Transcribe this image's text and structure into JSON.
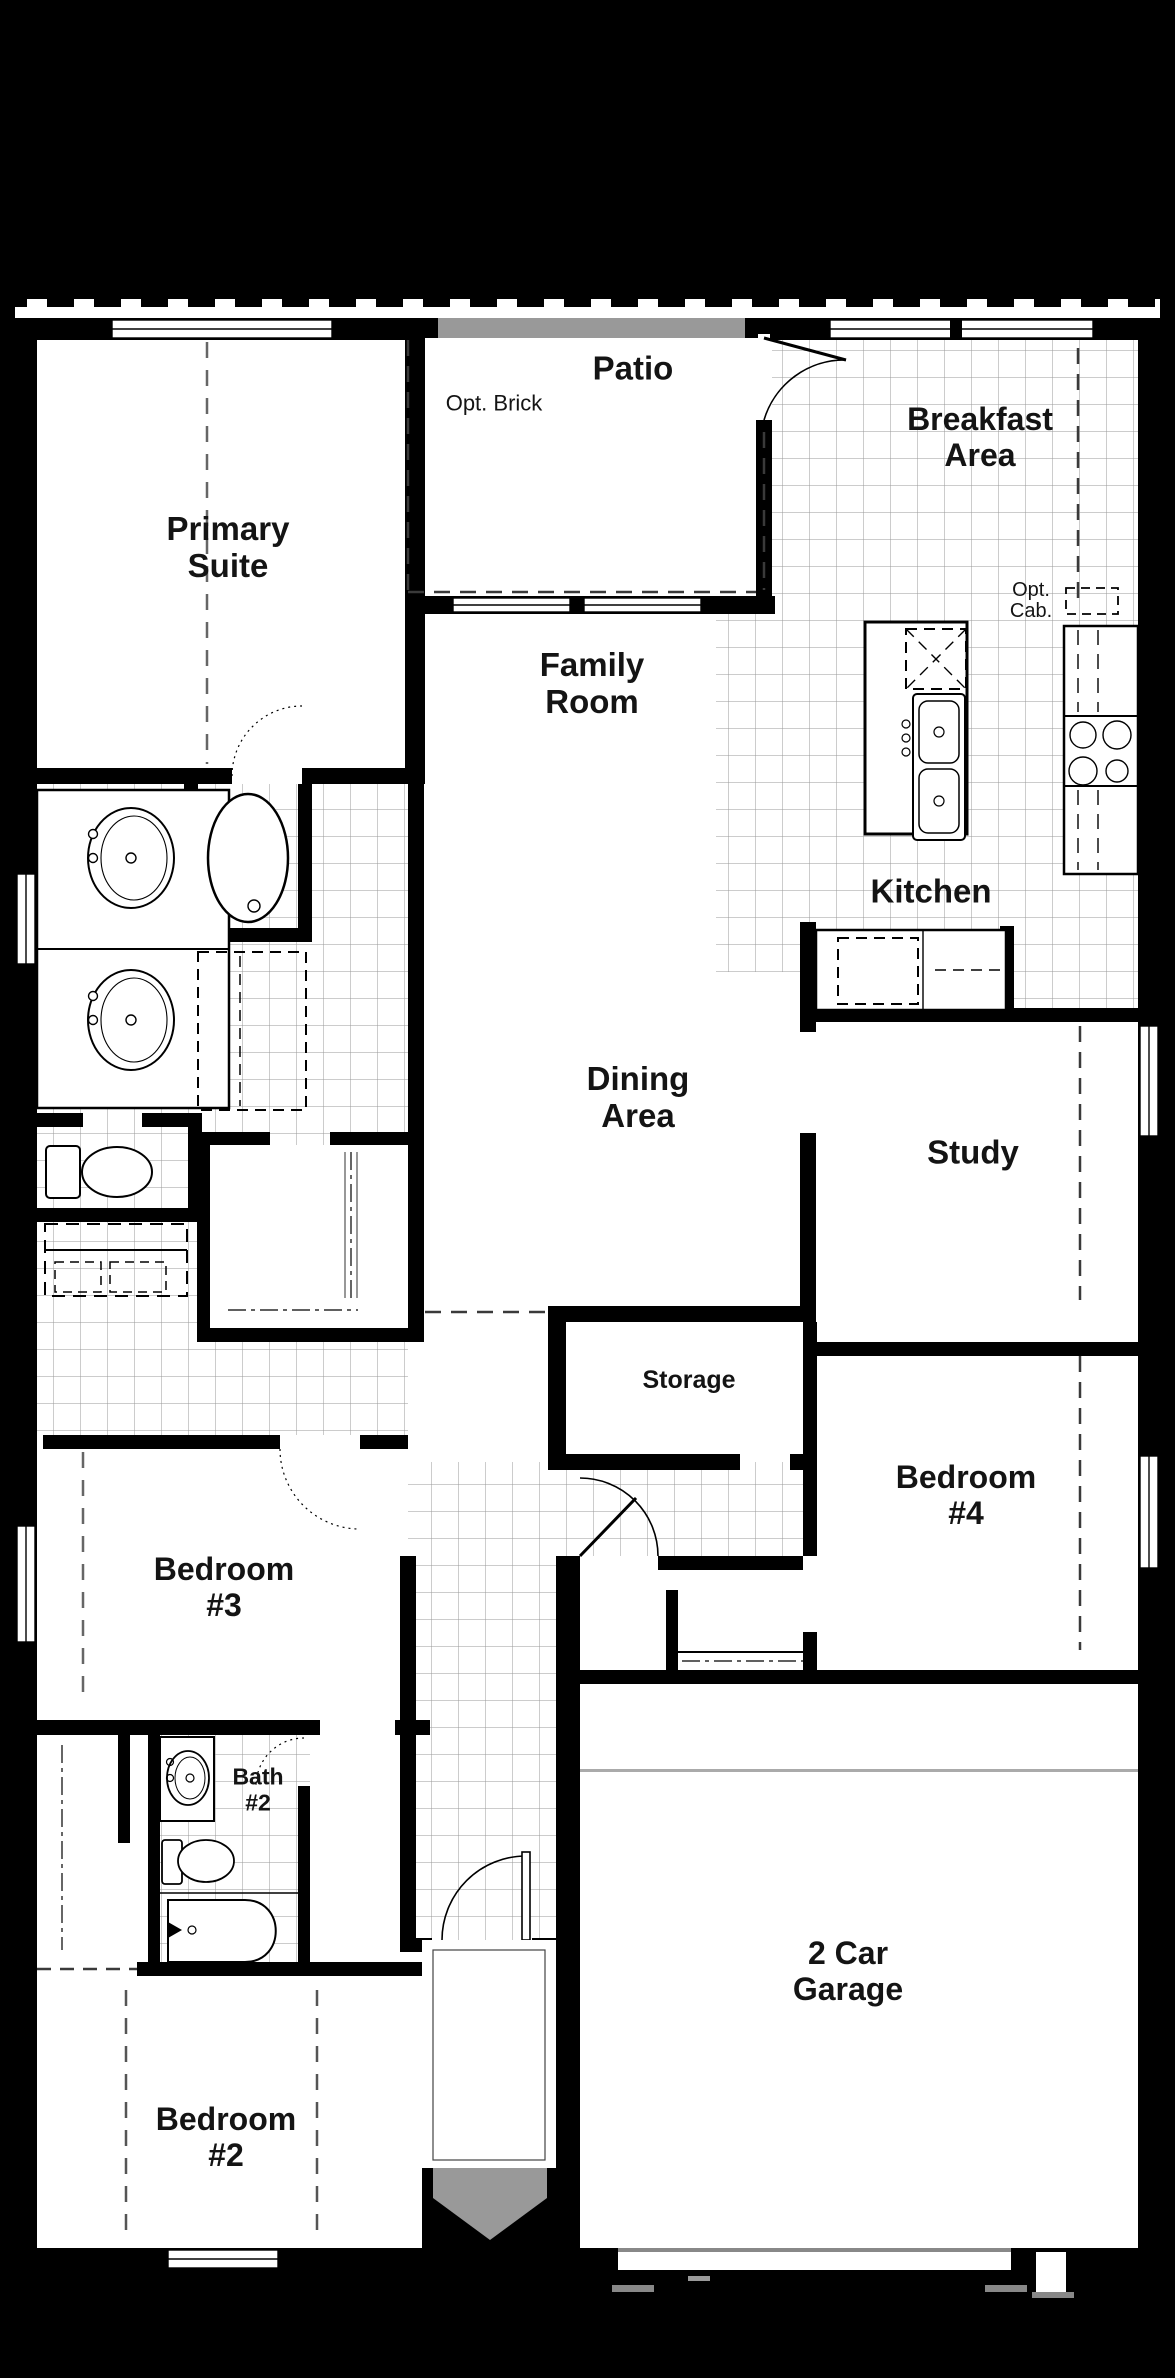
{
  "page": {
    "background": "#000000",
    "paper": "#ffffff"
  },
  "colors": {
    "wall": "#000000",
    "tile_grid": "#9a9a9a",
    "patio_roof_bar": "#999999",
    "entry_marker": "#999999",
    "garage_door_line": "#888888",
    "dash_line": "#3a3a3a"
  },
  "rooms": [
    {
      "key": "patio",
      "label": "Patio"
    },
    {
      "key": "opt-brick",
      "label": "Opt. Brick"
    },
    {
      "key": "breakfast-area",
      "label": "Breakfast\nArea"
    },
    {
      "key": "primary-suite",
      "label": "Primary\nSuite"
    },
    {
      "key": "family-room",
      "label": "Family\nRoom"
    },
    {
      "key": "opt-cab",
      "label": "Opt.\nCab."
    },
    {
      "key": "kitchen",
      "label": "Kitchen"
    },
    {
      "key": "dining-area",
      "label": "Dining\nArea"
    },
    {
      "key": "study",
      "label": "Study"
    },
    {
      "key": "storage",
      "label": "Storage"
    },
    {
      "key": "bedroom-4",
      "label": "Bedroom\n#4"
    },
    {
      "key": "bedroom-3",
      "label": "Bedroom\n#3"
    },
    {
      "key": "bath-2",
      "label": "Bath\n#2"
    },
    {
      "key": "bedroom-2",
      "label": "Bedroom\n#2"
    },
    {
      "key": "garage",
      "label": "2 Car\nGarage"
    }
  ],
  "fixtures": [
    "double-vanity-sinks",
    "garden-tub",
    "walk-in-shower",
    "toilet",
    "washer-dryer-space",
    "closet-rods",
    "kitchen-island",
    "island-double-sink",
    "opt-cooktop",
    "range-burners",
    "refrigerator-space",
    "pantry-counter",
    "bath2-vanity-sink",
    "bath2-toilet",
    "bathtub",
    "front-door-swing",
    "patio-door-swing",
    "hall-door-swing",
    "garage-door-line",
    "entry-arrow"
  ]
}
